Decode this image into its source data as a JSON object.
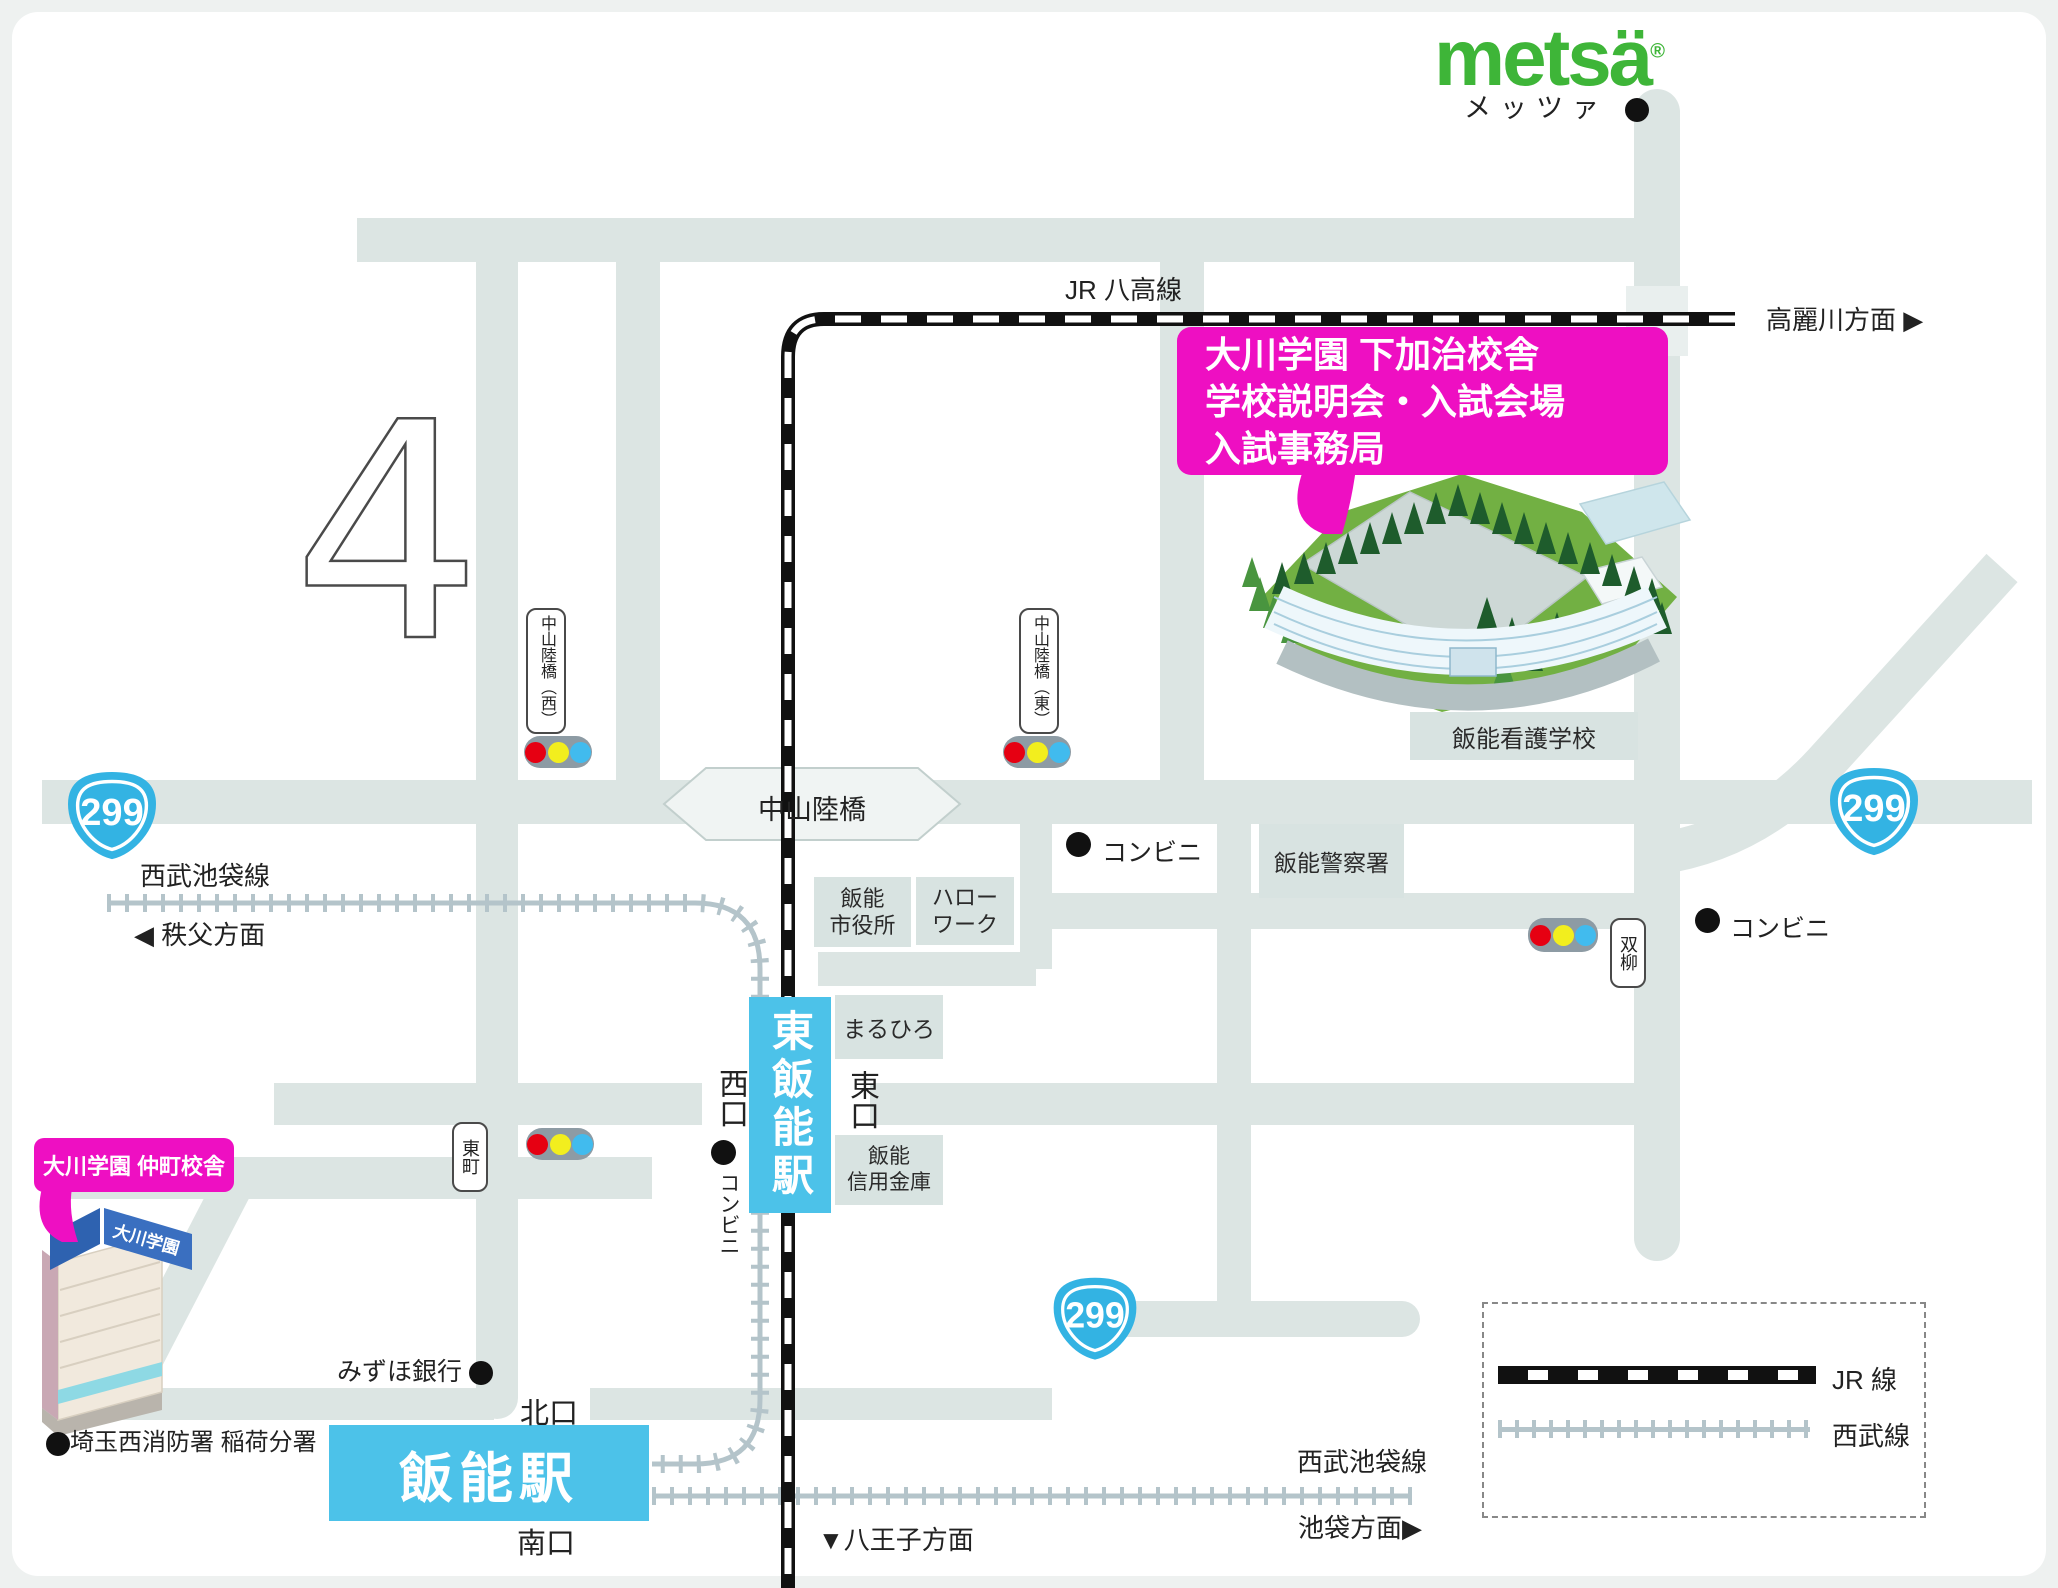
{
  "logo": {
    "wordmark": "metsä",
    "registered": "®",
    "katakana": "メッツァ"
  },
  "map_mark": {
    "numeral": "4"
  },
  "arrows": {
    "right": "▶",
    "left": "◀",
    "down": "▼"
  },
  "rail": {
    "jr_hachiko": "JR 八高線",
    "komagawa": "高麗川方面",
    "chichibu": "秩父方面",
    "seibu_ikebukuro_left": "西武池袋線",
    "seibu_ikebukuro_bottom": "西武池袋線",
    "ikebukuro": "池袋方面",
    "hachioji": "八王子方面"
  },
  "route": {
    "number": "299"
  },
  "callout_shimokaji": {
    "line1": "大川学園 下加治校舎",
    "line2": "学校説明会・入試会場",
    "line3": "入試事務局"
  },
  "callout_nakacho": {
    "label": "大川学園 仲町校舎",
    "building_sign": "大川学園"
  },
  "stations": {
    "higashi_hanno": "東飯能駅",
    "hanno": "飯能駅",
    "west_exit": "西口",
    "east_exit": "東口",
    "north_exit": "北口",
    "south_exit": "南口"
  },
  "places": {
    "city_hall_1": "飯能",
    "city_hall_2": "市役所",
    "hello_work_1": "ハロー",
    "hello_work_2": "ワーク",
    "police": "飯能警察署",
    "nursing_school": "飯能看護学校",
    "maruhiro": "まるひろ",
    "shinkin_1": "飯能",
    "shinkin_2": "信用金庫",
    "mizuho": "みずほ銀行",
    "fire_station": "埼玉西消防署 稲荷分署",
    "convenience": "コンビニ"
  },
  "signs": {
    "nakayama_west": "中山陸橋（西）",
    "nakayama_east": "中山陸橋（東）",
    "nakayama": "中山陸橋",
    "higashicho": "東町",
    "futatsuyanagi": "双柳"
  },
  "legend": {
    "jr": "JR 線",
    "seibu": "西武線"
  },
  "colors": {
    "accent_pink": "#ee0fc2",
    "station_cyan": "#4cc2e9",
    "logo_green": "#3eb538",
    "route_blue": "#33b3e3",
    "road_gray": "#dce5e3"
  }
}
